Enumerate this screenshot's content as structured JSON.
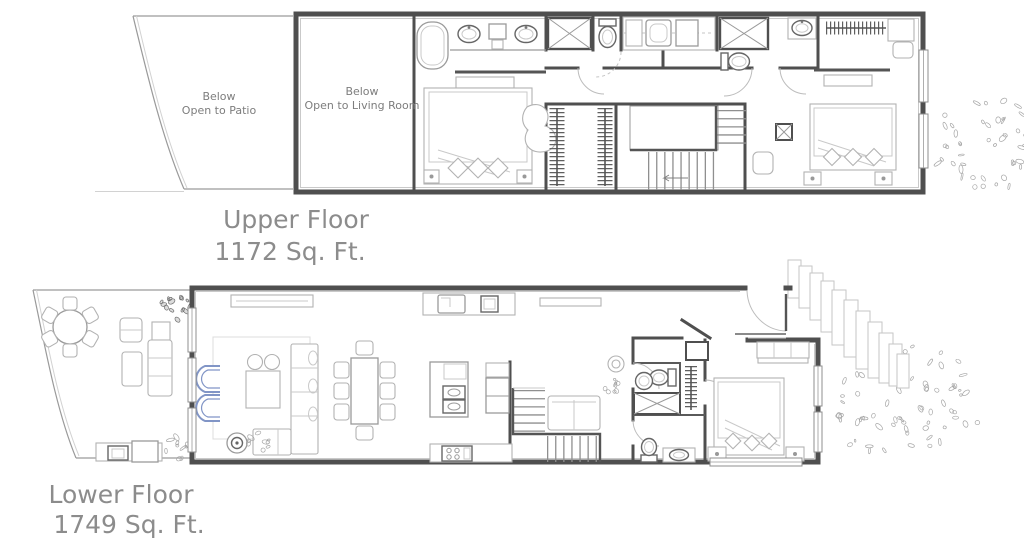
{
  "drawing_title": "Two-story residence floor plan",
  "colors": {
    "wall": "#4f4f4f",
    "furniture": "#9a9a9a",
    "accent_blue": "#8195c6",
    "label_text": "#8c8c8c",
    "annotation_text": "#7d7d7d",
    "foliage": "#a6a6a6",
    "background": "#ffffff"
  },
  "upper_floor": {
    "name": "Upper Floor",
    "area": "1172 Sq. Ft.",
    "annotations": [
      {
        "line1": "Below",
        "line2": "Open to Patio"
      },
      {
        "line1": "Below",
        "line2": "Open to Living Room"
      }
    ]
  },
  "lower_floor": {
    "name": "Lower Floor",
    "area": "1749 Sq. Ft."
  }
}
